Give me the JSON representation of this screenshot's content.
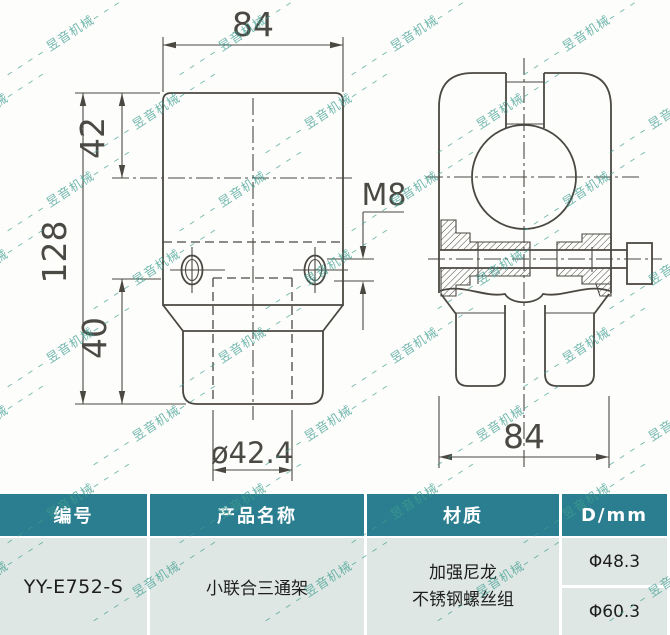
{
  "watermark": {
    "text": "昱音机械",
    "trail": "– – – – ",
    "color": "#3E9E90"
  },
  "drawing": {
    "dimensions": {
      "width_top": "84",
      "upper_height": "42",
      "total_height": "128",
      "lower_height": "40",
      "thread": "M8",
      "bore": "ø42.4",
      "side_width": "84"
    }
  },
  "table": {
    "headers": [
      "编号",
      "产品名称",
      "材质",
      "D/mm"
    ],
    "row": {
      "code": "YY-E752-S",
      "product_name": "小联合三通架",
      "material_line1": "加强尼龙",
      "material_line2": "不锈钢螺丝组",
      "d_value_1": "Φ48.3",
      "d_value_2": "Φ60.3"
    }
  },
  "colors": {
    "header_bg": "#2b7e8f",
    "row_bg": "#dfe7e4",
    "line": "#4b4842",
    "watermark": "#3E9E90"
  }
}
